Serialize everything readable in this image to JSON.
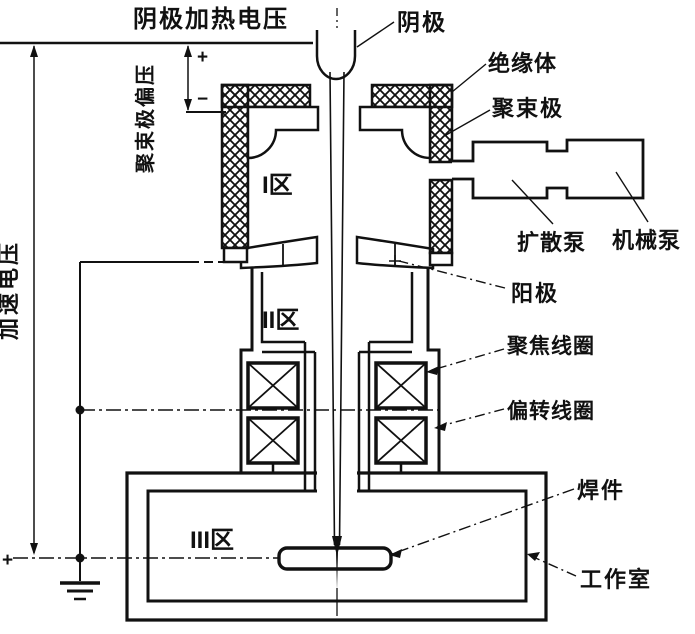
{
  "diagram_title": "电子束焊机结构示意图",
  "labels": {
    "cathode_heating_voltage": "阴极加热电压",
    "cathode": "阴极",
    "insulator": "绝缘体",
    "focusing_electrode": "聚束极",
    "focusing_electrode_bias": "聚束极偏压",
    "accelerating_voltage": "加速电压",
    "zone_1": "I区",
    "zone_2": "II区",
    "zone_3": "III区",
    "diffusion_pump": "扩散泵",
    "mechanical_pump": "机械泵",
    "anode": "阳极",
    "focusing_coil": "聚焦线圈",
    "deflection_coil": "偏转线圈",
    "weldment": "焊件",
    "work_chamber": "工作室",
    "bias_plus": "+",
    "bias_minus": "−",
    "ground_plus": "+"
  },
  "colors": {
    "line": "#111111",
    "background": "#ffffff"
  }
}
